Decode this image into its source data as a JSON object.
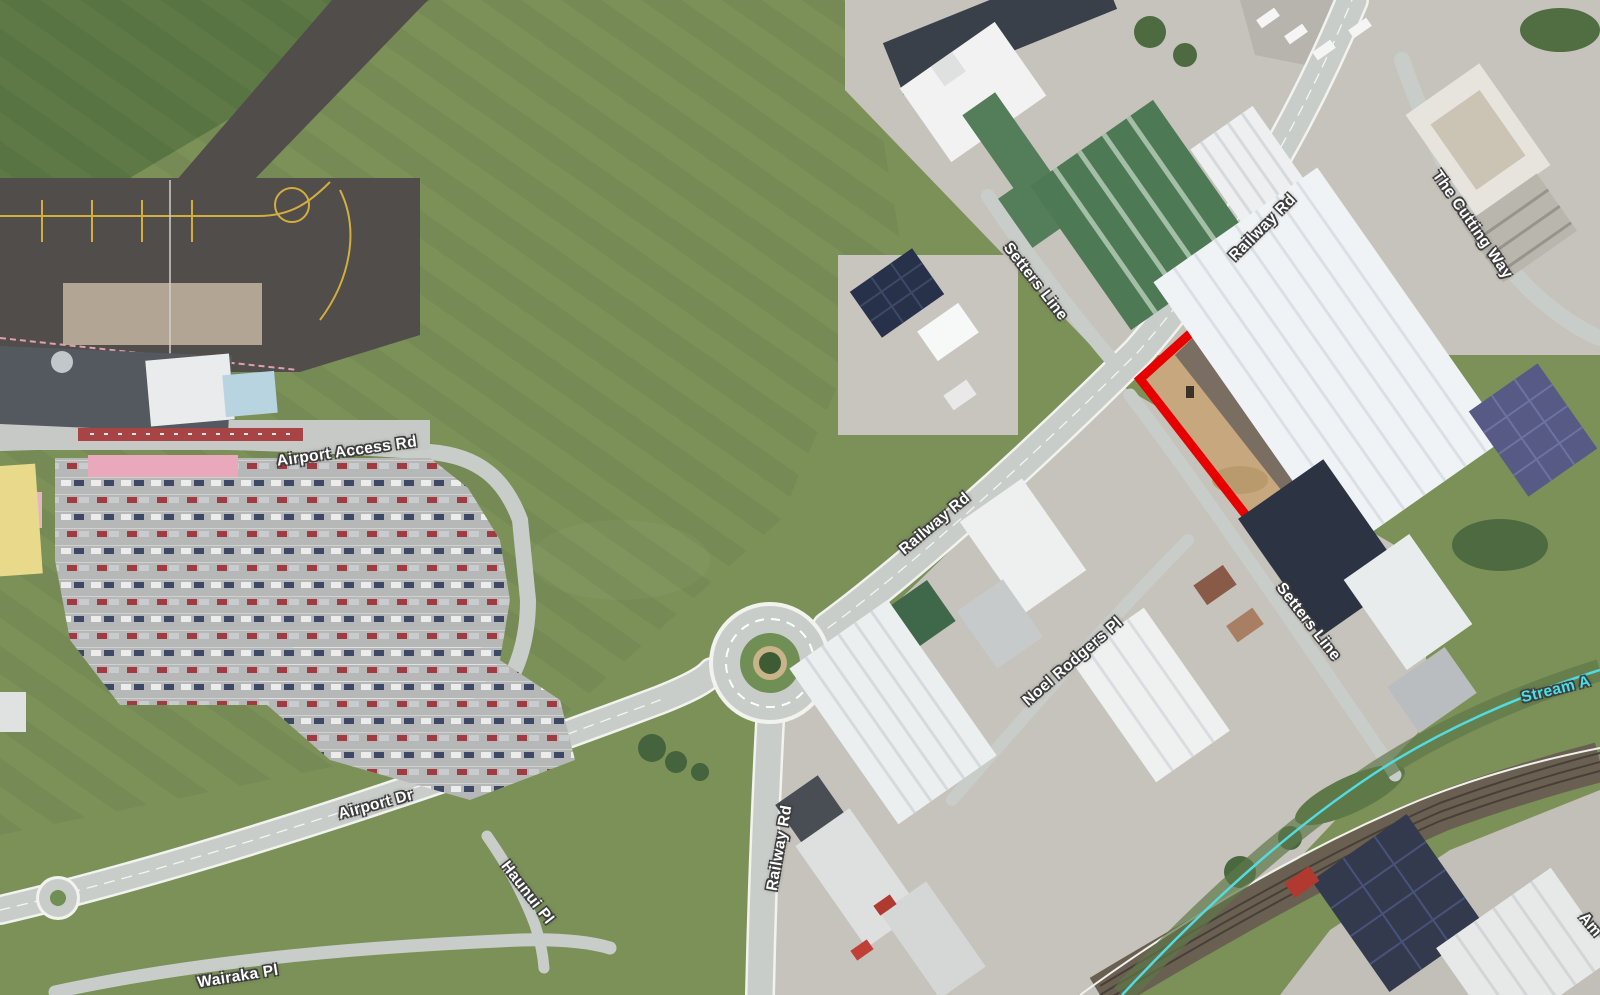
{
  "map": {
    "description": "Aerial imagery of an airport and industrial area with a highlighted parcel",
    "road_labels": {
      "airport_access_rd": "Airport Access Rd",
      "railway_rd": "Railway Rd",
      "setters_line": "Setters Line",
      "the_cutting_way": "The Cutting Way",
      "airport_dr": "Airport Dr",
      "haunui_pl": "Haunui Pl",
      "noel_rodgers_pl": "Noel Rodgers Pl",
      "wairaka_pl": "Wairaka Pl",
      "am_partial": "Am"
    },
    "water_labels": {
      "stream_a": "Stream A"
    },
    "colors": {
      "highlight_outline": "#e60000",
      "stream": "#52dce2",
      "road": "#c9cdc9",
      "grass": "#7b9158",
      "apron": "#504d4a"
    }
  }
}
